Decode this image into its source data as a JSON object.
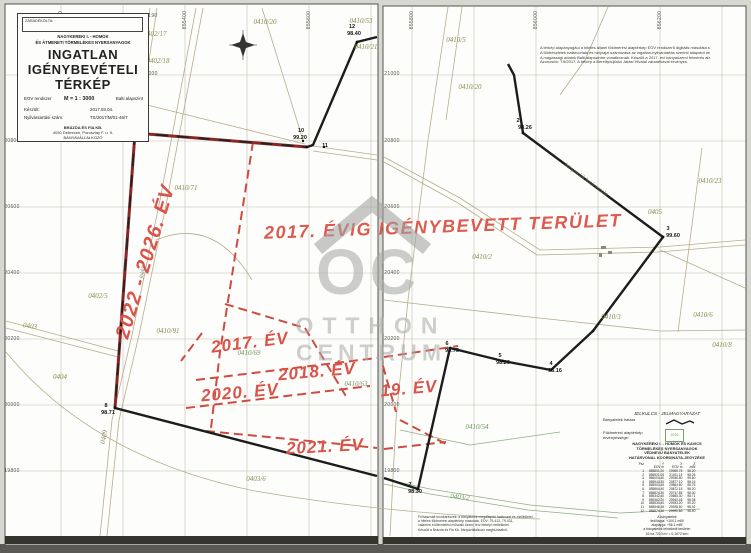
{
  "colors": {
    "paper": "#fdfdfb",
    "background": "#d7d7d2",
    "grid_line": "#c2c2b2",
    "parcel_line": "#b6ad8c",
    "red_annotation": "#d9544a",
    "dark_red_boundary": "#8b2727",
    "black_boundary": "#1c1c1c",
    "watermark_gray": "#a9a9a9",
    "parcel_label_olive": "#8c8c52",
    "parcel_label_green": "#6f9a5f"
  },
  "title_block": {
    "stamp_box_label": "ZÁRADÉKOLTA:",
    "subject_line1": "NAGYKEREKI I. - HOMOK",
    "subject_line2": "ÉS ÁTMENETI TÖRMELÉKES NYERSANYAGOK",
    "title_line1": "INGATLAN",
    "title_line2": "IGÉNYBEVÉTELI",
    "title_line3": "TÉRKÉP",
    "system_label": "EOV rendszer",
    "scale": "M = 1 : 3000",
    "datum": "Balti alapszint",
    "made_label": "Készült:",
    "made_value": "2017.03.04.",
    "registry_label": "Nyilvántartási szám:",
    "registry_value": "TS/2017/M/01-46/7",
    "company_line1": "BRÁZDA ÉS FIA KB.",
    "company_line2": "4030 Debrecen, Poroszlay F. u. 9.",
    "company_line3": "BÁNYAVÁLLALKOZÓ"
  },
  "watermark": {
    "monogram": "OC",
    "name_line1": "OTTHON",
    "name_line2": "CENTRUM"
  },
  "notes_top": {
    "lines": [
      "A térkép alapanyagául a hiteles állami földmérési alaptérkép EOV rendszerű digitális másolata szolgált.",
      "A földrészletek határvonala és helyrajzi számozása az ingatlan-nyilvántartás szerinti állapotot mutatja.",
      "A magassági adatok Balti alapszintre vonatkoznak. Készült a 2017. évi bányaüzemi felmérés alapján.",
      "Azonosító: T.5/2017. A térkép a Berettyóújfalui Járási Hivatal záradékával érvényes."
    ]
  },
  "notes_bottom": {
    "lines": [
      "Felhasznált munkarészek: a bányatelek megállapító határozat és mellékletei,",
      "a hiteles földmérési alaptérkép másolata, EOV: 79-413, 79-431,",
      "valamint a kitermelési műszaki üzemi terv térképi mellékletei.",
      "Készült a Brázda és Fia Kb. bányavállalkozó megbízásából."
    ]
  },
  "legend": {
    "heading": "JELKULCS - JELMAGYARÁZAT",
    "item1_label": "Bányatelek határa",
    "item2_label": "Földmérési alaptérkép érvényessége:",
    "stamp_text": "2016",
    "title_lines": [
      "NAGYKEREKI I. - HOMOK ÉS KAVICS",
      "TÖRMELÉKES NYERSANYAGOK",
      "VÉDNEVŰ BÁNYATELEK",
      "HATÁRVONAL KOORDINÁTA-JEGYZÉKE"
    ],
    "table": {
      "columns": [
        "Psz",
        "Y",
        "X",
        "Z"
      ],
      "units": [
        "",
        "EOV m",
        "EOV m",
        "mBf"
      ],
      "rows": [
        [
          "1",
          "855801.20",
          "20965.75",
          "98.20"
        ],
        [
          "2",
          "855921.05",
          "21011.15",
          "98.26"
        ],
        [
          "3",
          "856004.40",
          "20936.80",
          "99.60"
        ],
        [
          "4",
          "855944.30",
          "20877.10",
          "98.16"
        ],
        [
          "5",
          "855903.45",
          "20864.60",
          "98.75"
        ],
        [
          "6",
          "855864.40",
          "20872.15",
          "98.20"
        ],
        [
          "7",
          "855824.30",
          "20747.85",
          "98.30"
        ],
        [
          "8",
          "855342.40",
          "20665.30",
          "98.71"
        ],
        [
          "9",
          "855362.20",
          "20940.45",
          "98.38"
        ],
        [
          "10",
          "855530.40",
          "20933.20",
          "99.20"
        ],
        [
          "11",
          "855546.35",
          "20928.50",
          "98.92"
        ],
        [
          "12",
          "855574.30",
          "20990.85",
          "98.40"
        ]
      ]
    },
    "footer_lines": [
      "A bányatelek",
      "fedőlapja:  +100,1 mBf",
      "alaplapja:   +96,1 mBf",
      "a bányatelek lehatárolt területe:",
      "16 ha 7210 m² = 0,1672 km²"
    ]
  },
  "map_labels": [
    {
      "t": "2017. ÉVIG IGÉNYBEVETT TERÜLET",
      "x": 443,
      "y": 227,
      "r": -2,
      "c": "red-title"
    },
    {
      "t": "2022 - 2026. ÉV",
      "x": 146,
      "y": 262,
      "r": -73,
      "c": "year-big"
    },
    {
      "t": "2017. ÉV",
      "x": 250,
      "y": 343,
      "r": -7,
      "c": "year"
    },
    {
      "t": "2018. ÉV",
      "x": 317,
      "y": 372,
      "r": -5,
      "c": "year"
    },
    {
      "t": "2020. ÉV",
      "x": 240,
      "y": 393,
      "r": -5,
      "c": "year"
    },
    {
      "t": "2021. ÉV",
      "x": 325,
      "y": 447,
      "r": -3,
      "c": "year"
    },
    {
      "t": "19. ÉV",
      "x": 409,
      "y": 389,
      "r": -5,
      "c": "year"
    },
    {
      "t": "0402/17",
      "x": 155,
      "y": 34,
      "r": 0,
      "c": "parcel"
    },
    {
      "t": "0402/18",
      "x": 158,
      "y": 61,
      "r": 0,
      "c": "parcel"
    },
    {
      "t": "0410/20",
      "x": 265,
      "y": 22,
      "r": 0,
      "c": "parcel"
    },
    {
      "t": "0410/53",
      "x": 361,
      "y": 21,
      "r": 0,
      "c": "parcel"
    },
    {
      "t": "0410/21",
      "x": 366,
      "y": 47,
      "r": 0,
      "c": "parcel"
    },
    {
      "t": "0410/71",
      "x": 186,
      "y": 188,
      "r": 0,
      "c": "parcel"
    },
    {
      "t": "0402/5",
      "x": 98,
      "y": 296,
      "r": 0,
      "c": "parcel"
    },
    {
      "t": "0404",
      "x": 60,
      "y": 377,
      "r": 0,
      "c": "parcel"
    },
    {
      "t": "0403",
      "x": 30,
      "y": 326,
      "r": 8,
      "c": "parcel"
    },
    {
      "t": "0410/91",
      "x": 168,
      "y": 331,
      "r": 0,
      "c": "parcel"
    },
    {
      "t": "0409",
      "x": 104,
      "y": 437,
      "r": -78,
      "c": "parcel"
    },
    {
      "t": "0403/6",
      "x": 256,
      "y": 479,
      "r": 0,
      "c": "parcel"
    },
    {
      "t": "0410/69",
      "x": 249,
      "y": 353,
      "r": 0,
      "c": "parcel-green"
    },
    {
      "t": "0410/63",
      "x": 356,
      "y": 384,
      "r": 0,
      "c": "parcel-green"
    },
    {
      "t": "0410/5",
      "x": 456,
      "y": 40,
      "r": 0,
      "c": "parcel"
    },
    {
      "t": "0410/20",
      "x": 470,
      "y": 87,
      "r": 0,
      "c": "parcel"
    },
    {
      "t": "0410/23",
      "x": 710,
      "y": 181,
      "r": 0,
      "c": "parcel"
    },
    {
      "t": "0405",
      "x": 655,
      "y": 212,
      "r": 0,
      "c": "parcel"
    },
    {
      "t": "0410/2",
      "x": 482,
      "y": 257,
      "r": 0,
      "c": "parcel"
    },
    {
      "t": "0410/3",
      "x": 611,
      "y": 317,
      "r": 0,
      "c": "parcel"
    },
    {
      "t": "0410/6",
      "x": 703,
      "y": 315,
      "r": 0,
      "c": "parcel"
    },
    {
      "t": "0410/8",
      "x": 722,
      "y": 345,
      "r": 0,
      "c": "parcel"
    },
    {
      "t": "0410/54",
      "x": 477,
      "y": 427,
      "r": 0,
      "c": "parcel-green"
    },
    {
      "t": "0403/2",
      "x": 460,
      "y": 497,
      "r": 6,
      "c": "parcel-green"
    },
    {
      "t": "12",
      "x": 352,
      "y": 27,
      "r": 0,
      "c": "point"
    },
    {
      "t": "98.40",
      "x": 354,
      "y": 34,
      "r": 0,
      "c": "point"
    },
    {
      "t": "10",
      "x": 301,
      "y": 131,
      "r": 0,
      "c": "point"
    },
    {
      "t": "99.20",
      "x": 300,
      "y": 138,
      "r": 0,
      "c": "point"
    },
    {
      "t": "11",
      "x": 325,
      "y": 146,
      "r": 0,
      "c": "point"
    },
    {
      "t": "9",
      "x": 126,
      "y": 119,
      "r": 0,
      "c": "point"
    },
    {
      "t": "98.38",
      "x": 129,
      "y": 126,
      "r": 0,
      "c": "point"
    },
    {
      "t": "8",
      "x": 106,
      "y": 406,
      "r": 0,
      "c": "point"
    },
    {
      "t": "98.71",
      "x": 108,
      "y": 413,
      "r": 0,
      "c": "point"
    },
    {
      "t": "2",
      "x": 518,
      "y": 121,
      "r": 0,
      "c": "point"
    },
    {
      "t": "98.26",
      "x": 525,
      "y": 128,
      "r": 0,
      "c": "point"
    },
    {
      "t": "3",
      "x": 668,
      "y": 229,
      "r": 0,
      "c": "point"
    },
    {
      "t": "99.60",
      "x": 673,
      "y": 236,
      "r": 0,
      "c": "point"
    },
    {
      "t": "4",
      "x": 551,
      "y": 364,
      "r": 0,
      "c": "point"
    },
    {
      "t": "98.16",
      "x": 555,
      "y": 371,
      "r": 0,
      "c": "point"
    },
    {
      "t": "5",
      "x": 500,
      "y": 356,
      "r": 0,
      "c": "point"
    },
    {
      "t": "98.20",
      "x": 503,
      "y": 363,
      "r": 0,
      "c": "point"
    },
    {
      "t": "6",
      "x": 447,
      "y": 344,
      "r": 0,
      "c": "point"
    },
    {
      "t": "98.75",
      "x": 452,
      "y": 351,
      "r": 0,
      "c": "point"
    },
    {
      "t": "7",
      "x": 410,
      "y": 485,
      "r": 0,
      "c": "point"
    },
    {
      "t": "98.30",
      "x": 415,
      "y": 492,
      "r": 0,
      "c": "point"
    },
    {
      "t": "21190",
      "x": 150,
      "y": 16,
      "r": 0,
      "c": "grid"
    },
    {
      "t": "21000",
      "x": 150,
      "y": 74,
      "r": 0,
      "c": "grid"
    },
    {
      "t": "20800",
      "x": 12,
      "y": 141,
      "r": 0,
      "c": "grid"
    },
    {
      "t": "20600",
      "x": 12,
      "y": 207,
      "r": 0,
      "c": "grid"
    },
    {
      "t": "20400",
      "x": 12,
      "y": 273,
      "r": 0,
      "c": "grid"
    },
    {
      "t": "20200",
      "x": 12,
      "y": 339,
      "r": 0,
      "c": "grid"
    },
    {
      "t": "20000",
      "x": 12,
      "y": 405,
      "r": 0,
      "c": "grid"
    },
    {
      "t": "19800",
      "x": 12,
      "y": 471,
      "r": 0,
      "c": "grid"
    },
    {
      "t": "21000",
      "x": 392,
      "y": 74,
      "r": 0,
      "c": "grid"
    },
    {
      "t": "20800",
      "x": 392,
      "y": 141,
      "r": 0,
      "c": "grid"
    },
    {
      "t": "20600",
      "x": 392,
      "y": 207,
      "r": 0,
      "c": "grid"
    },
    {
      "t": "20400",
      "x": 392,
      "y": 273,
      "r": 0,
      "c": "grid"
    },
    {
      "t": "20200",
      "x": 392,
      "y": 339,
      "r": 0,
      "c": "grid"
    },
    {
      "t": "20000",
      "x": 392,
      "y": 405,
      "r": 0,
      "c": "grid"
    },
    {
      "t": "19800",
      "x": 392,
      "y": 471,
      "r": 0,
      "c": "grid"
    },
    {
      "t": "855200",
      "x": 61,
      "y": 20,
      "r": -90,
      "c": "grid-v"
    },
    {
      "t": "855400",
      "x": 185,
      "y": 20,
      "r": -90,
      "c": "grid-v"
    },
    {
      "t": "855600",
      "x": 309,
      "y": 20,
      "r": -90,
      "c": "grid-v"
    },
    {
      "t": "855800",
      "x": 412,
      "y": 20,
      "r": -90,
      "c": "grid-v"
    },
    {
      "t": "856000",
      "x": 536,
      "y": 20,
      "r": -90,
      "c": "grid-v"
    },
    {
      "t": "856200",
      "x": 660,
      "y": 20,
      "r": -90,
      "c": "grid-v"
    },
    {
      "t": "földút",
      "x": 143,
      "y": 272,
      "r": -80,
      "c": "road"
    },
    {
      "t": "bányatelek határvonala",
      "x": 586,
      "y": 180,
      "r": 36,
      "c": "road"
    }
  ]
}
